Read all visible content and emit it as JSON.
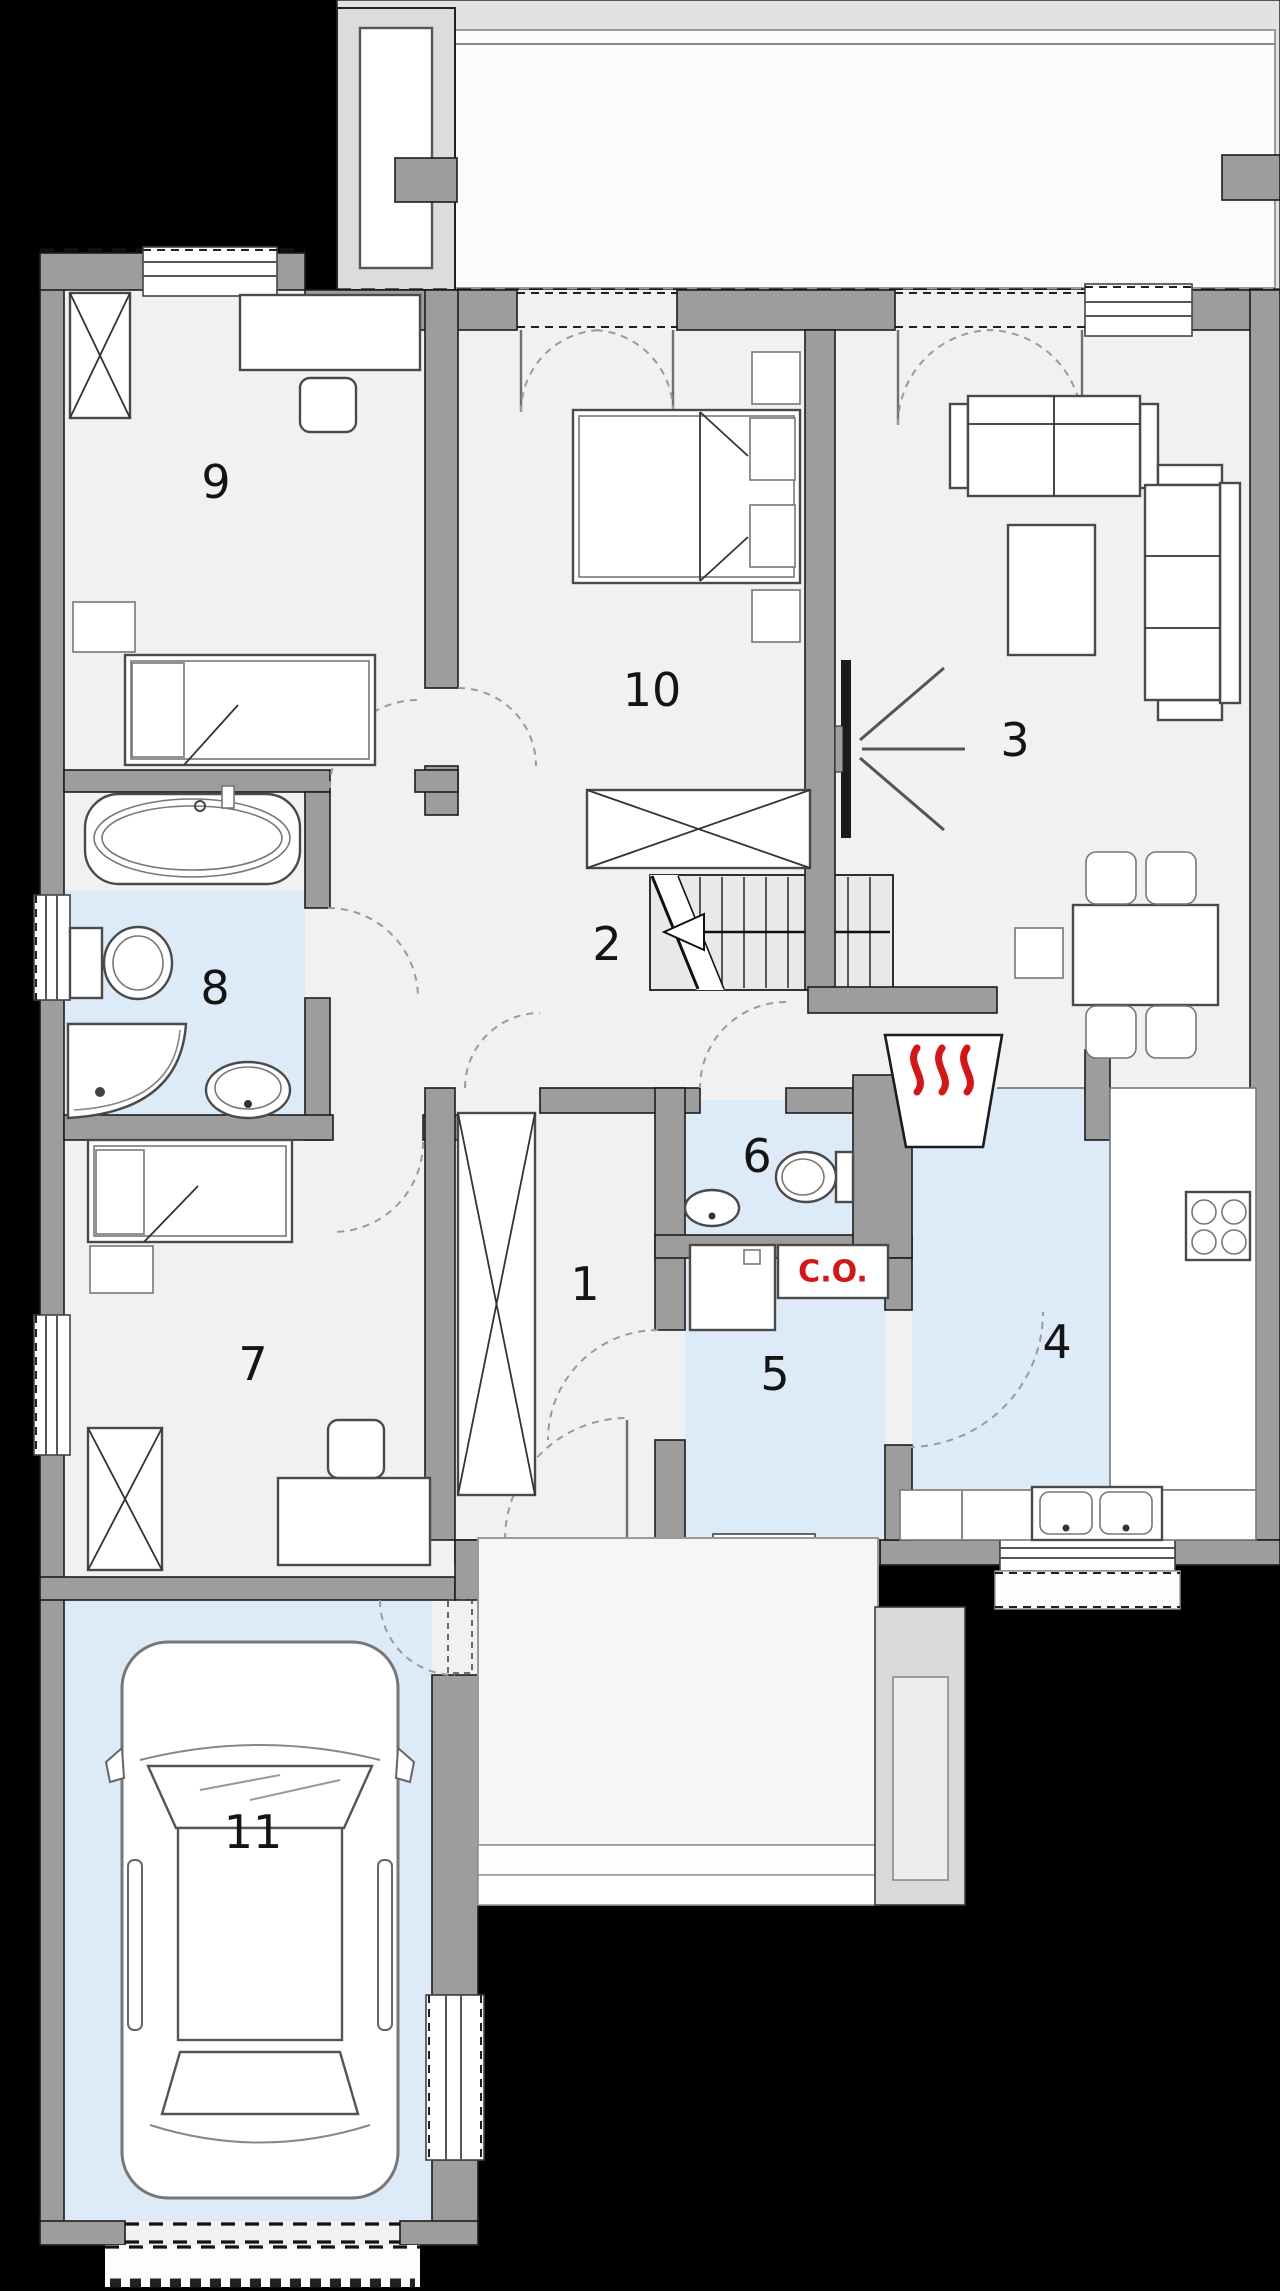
{
  "rooms": {
    "r1": {
      "label": "1"
    },
    "r2": {
      "label": "2"
    },
    "r3": {
      "label": "3"
    },
    "r4": {
      "label": "4"
    },
    "r5": {
      "label": "5"
    },
    "r6": {
      "label": "6"
    },
    "r7": {
      "label": "7"
    },
    "r8": {
      "label": "8"
    },
    "r9": {
      "label": "9"
    },
    "r10": {
      "label": "10"
    },
    "r11": {
      "label": "11"
    }
  },
  "boiler": {
    "label": "C.O."
  },
  "colors": {
    "background": "#000000",
    "wall": "#9d9d9d",
    "floor": "#f1f1f1",
    "wet_floor": "#dcebf7",
    "terrace": "#e2e2e2",
    "stairs": "#e9e9e9",
    "accent_red": "#d81414"
  }
}
